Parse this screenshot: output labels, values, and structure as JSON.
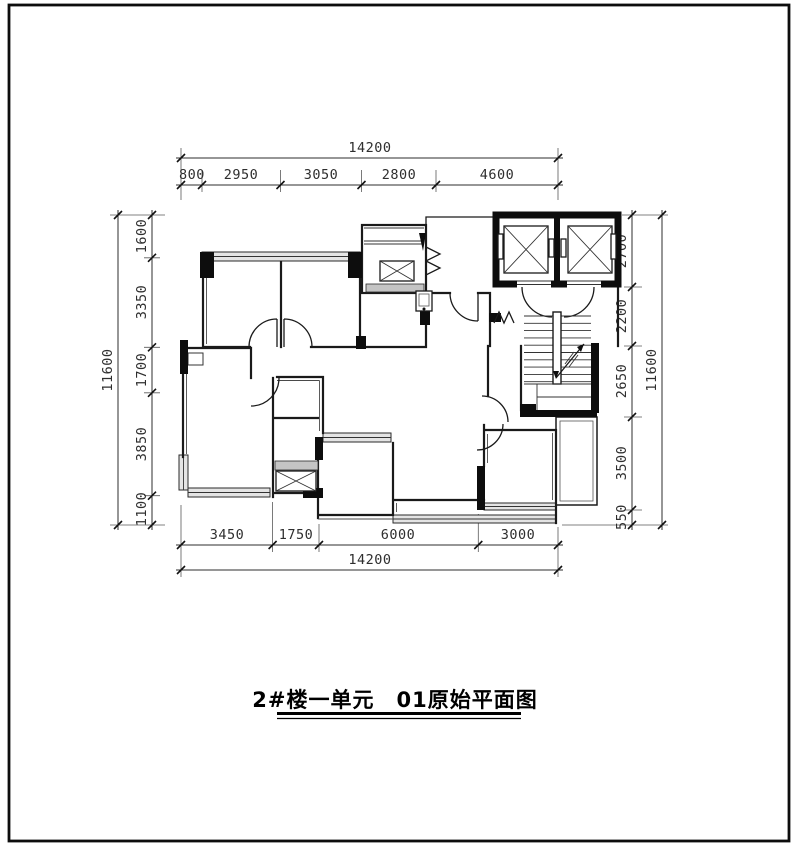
{
  "title_block": {
    "title": "2#楼一单元　01原始平面图"
  },
  "dimensions": {
    "top": {
      "total": "14200",
      "segments": [
        "800",
        "2950",
        "3050",
        "2800",
        "4600"
      ]
    },
    "bottom": {
      "total": "14200",
      "segments": [
        "3450",
        "1750",
        "6000",
        "3000"
      ]
    },
    "left": {
      "total": "11600",
      "segments": [
        "1600",
        "3350",
        "1700",
        "3850",
        "1100"
      ]
    },
    "right": {
      "total": "11600",
      "segments": [
        "2700",
        "2200",
        "2650",
        "3500",
        "550"
      ]
    }
  },
  "plan_features": {
    "elevators": "double-elevator-shaft",
    "staircase": "u-return-stair-with-direction-arrow",
    "shafts": [
      "bathroom-duct-x",
      "kitchen-duct-x"
    ],
    "unit": "residential-floor-plan"
  },
  "colors": {
    "line": "#1a1a1a",
    "dimension_text": "#2e2e2e",
    "window_band": "#e4e4e4",
    "wall_hatch": "#c4c4c4",
    "background": "#ffffff"
  }
}
